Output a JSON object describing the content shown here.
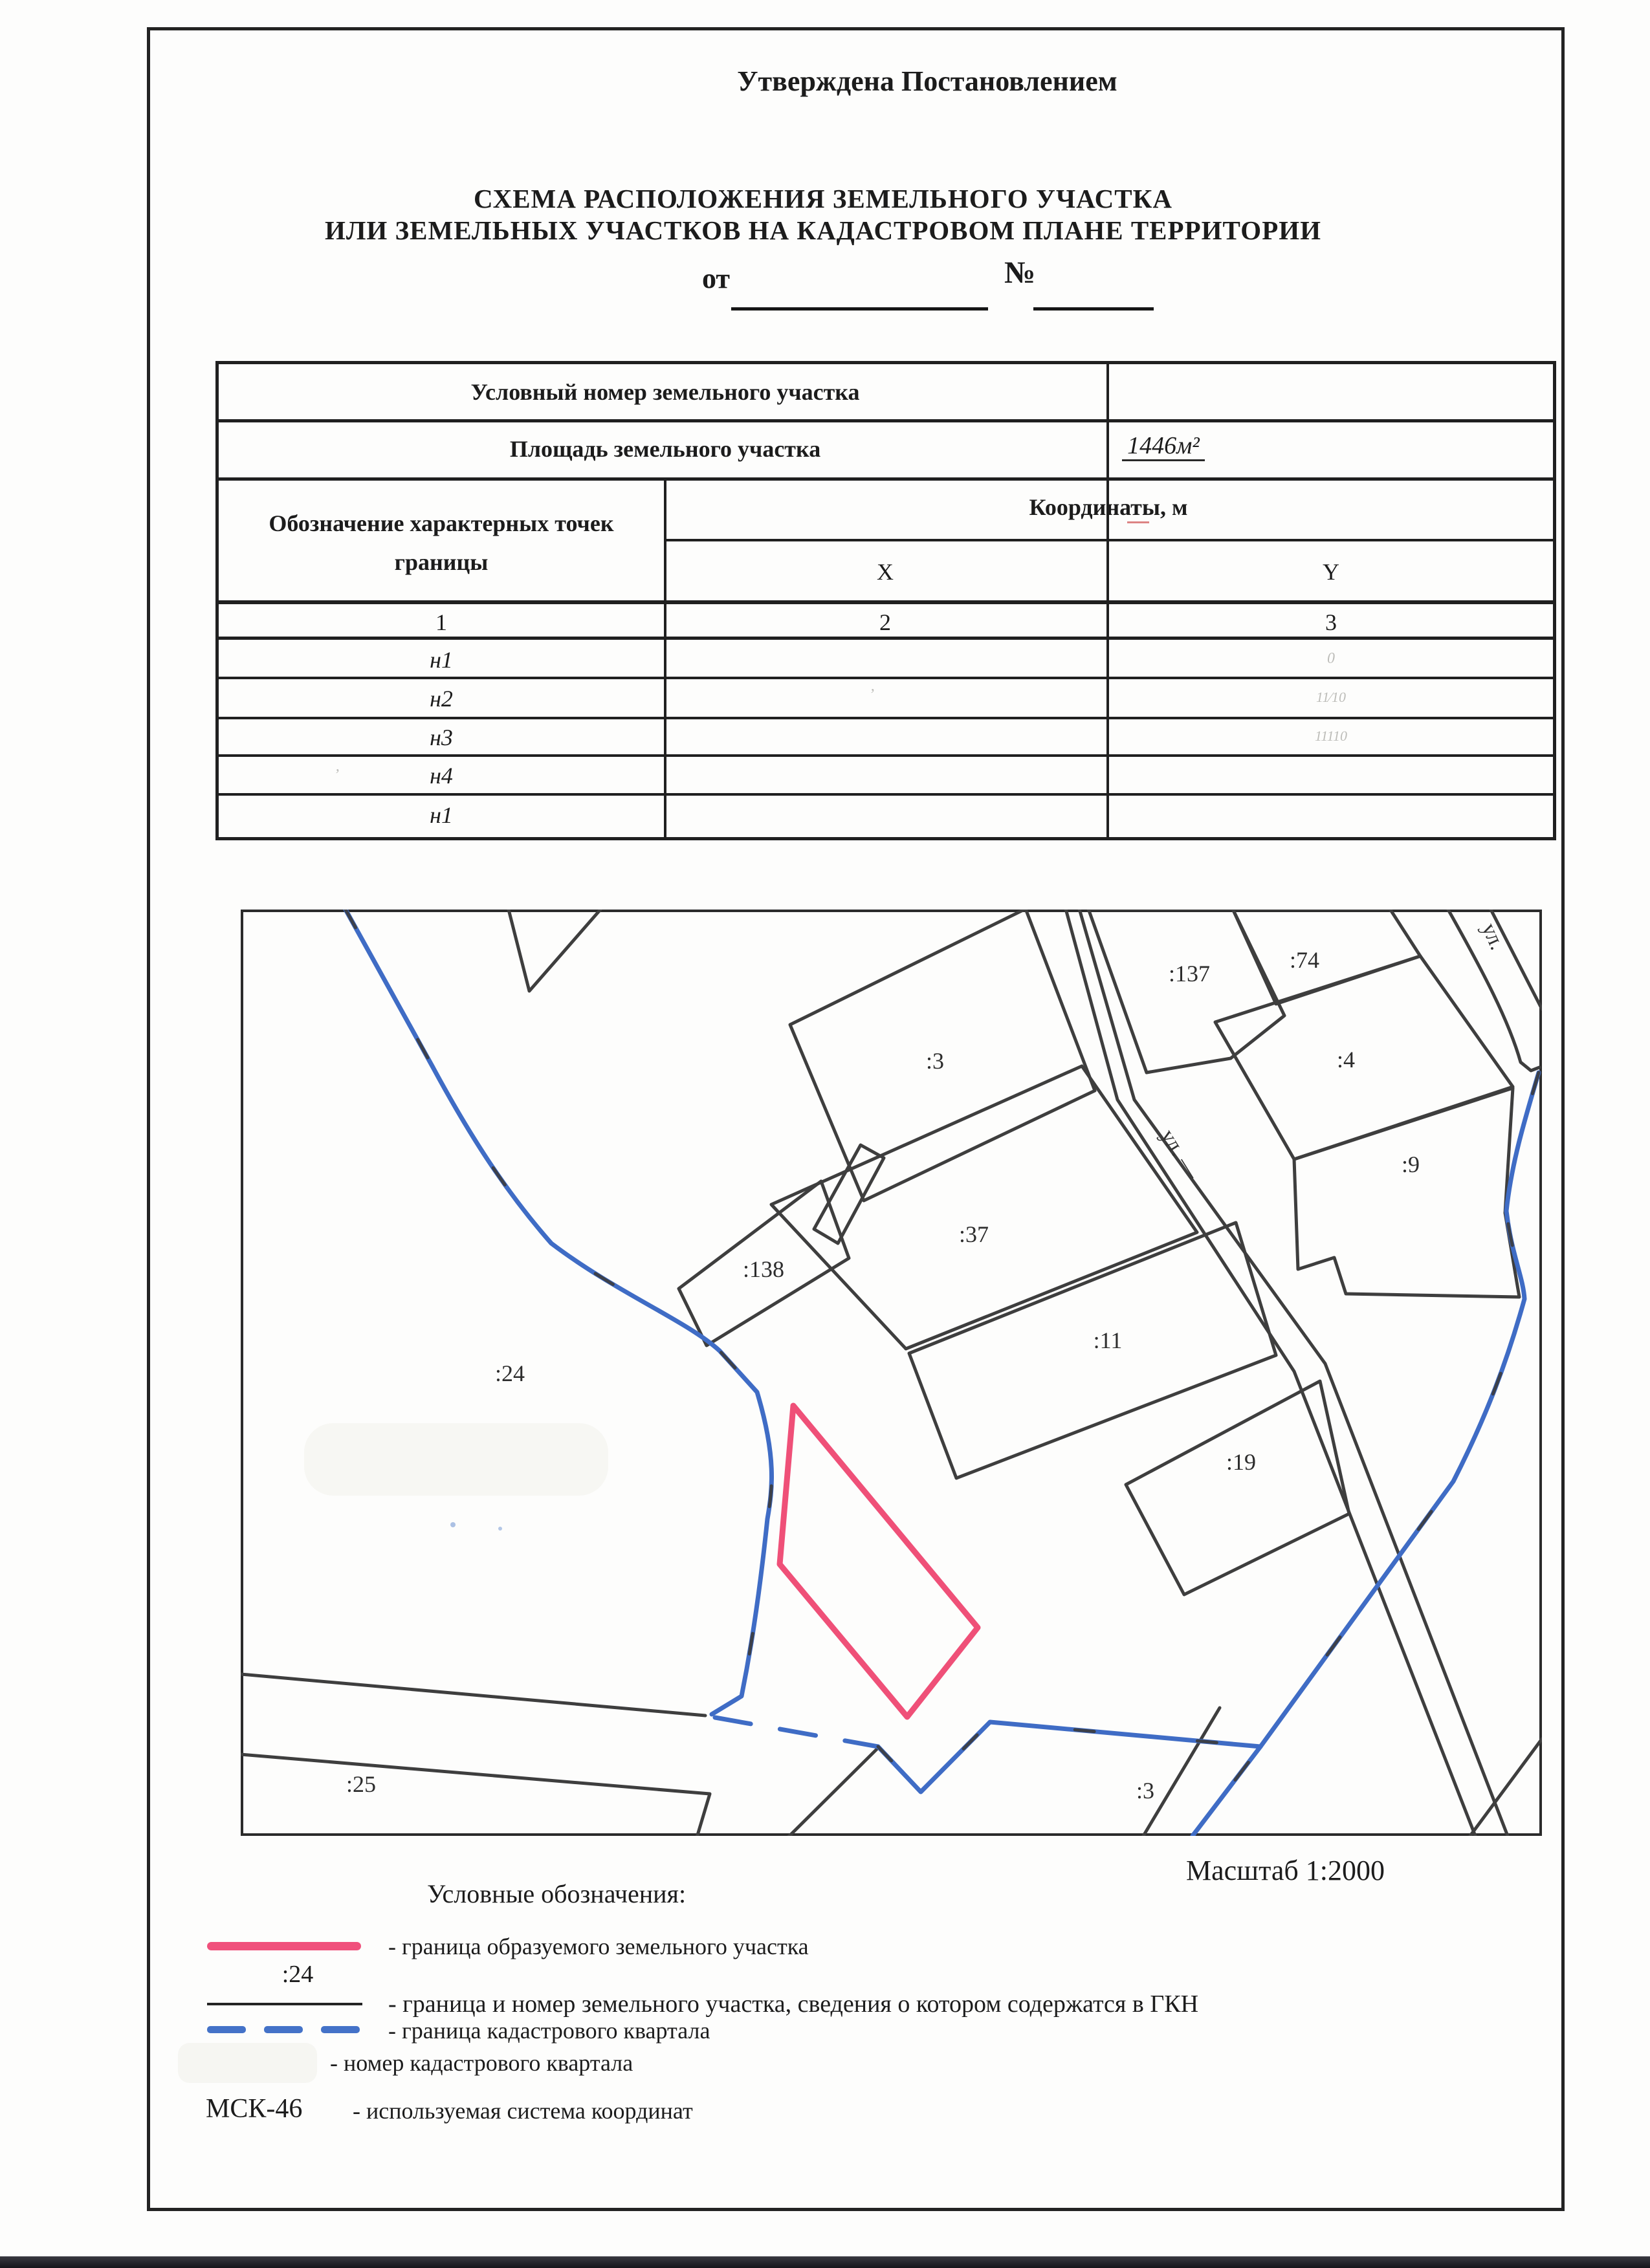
{
  "header": {
    "approved": "Утверждена Постановлением",
    "from_label": "от",
    "number_label": "№",
    "title_line1": "СХЕМА РАСПОЛОЖЕНИЯ ЗЕМЕЛЬНОГО УЧАСТКА",
    "title_line2": "ИЛИ ЗЕМЕЛЬНЫХ УЧАСТКОВ НА КАДАСТРОВОМ ПЛАНЕ ТЕРРИТОРИИ"
  },
  "table": {
    "conditional_number_label": "Условный номер земельного участка",
    "area_label": "Площадь земельного участка",
    "area_value": "1446м²",
    "points_header_line1": "Обозначение характерных точек",
    "points_header_line2": "границы",
    "coords_header": "Координаты, м",
    "col_x": "X",
    "col_y": "Y",
    "index_cols": [
      "1",
      "2",
      "3"
    ],
    "rows": [
      {
        "point": "н1",
        "x": "",
        "y": "0"
      },
      {
        "point": "н2",
        "x": "’",
        "y": "11⁄10"
      },
      {
        "point": "н3",
        "x": "",
        "y": "11110"
      },
      {
        "point": "н4",
        "x": "",
        "y": ""
      },
      {
        "point": "н1",
        "x": "",
        "y": ""
      }
    ],
    "n4_tick": "’"
  },
  "map": {
    "scale_label": "Масштаб 1:2000",
    "streets": [
      {
        "label": "ул. —"
      },
      {
        "label": "ул."
      }
    ],
    "parcels": [
      {
        "id": "137",
        "label": ":137"
      },
      {
        "id": "74",
        "label": ":74"
      },
      {
        "id": "3",
        "label": ":3"
      },
      {
        "id": "4",
        "label": ":4"
      },
      {
        "id": "9",
        "label": ":9"
      },
      {
        "id": "37",
        "label": ":37"
      },
      {
        "id": "138",
        "label": ":138"
      },
      {
        "id": "11",
        "label": ":11"
      },
      {
        "id": "19",
        "label": ":19"
      },
      {
        "id": "24",
        "label": ":24"
      },
      {
        "id": "25",
        "label": ":25"
      },
      {
        "id": "3b",
        "label": ":3"
      }
    ],
    "colors": {
      "boundary_blue": "#3f6cc5",
      "new_parcel_pink": "#ef5078",
      "parcel_line": "#3e3e3e"
    }
  },
  "legend": {
    "title": "Условные обозначения:",
    "rows": [
      {
        "symbol": "",
        "text": "- граница образуемого земельного участка"
      },
      {
        "symbol": ":24",
        "text": "- граница и номер земельного участка, сведения о котором содержатся в ГКН"
      },
      {
        "symbol": "",
        "text": "- граница кадастрового квартала"
      },
      {
        "symbol": "",
        "text": "- номер кадастрового квартала"
      },
      {
        "symbol": "МСК-46",
        "text": "- используемая система координат"
      }
    ]
  }
}
